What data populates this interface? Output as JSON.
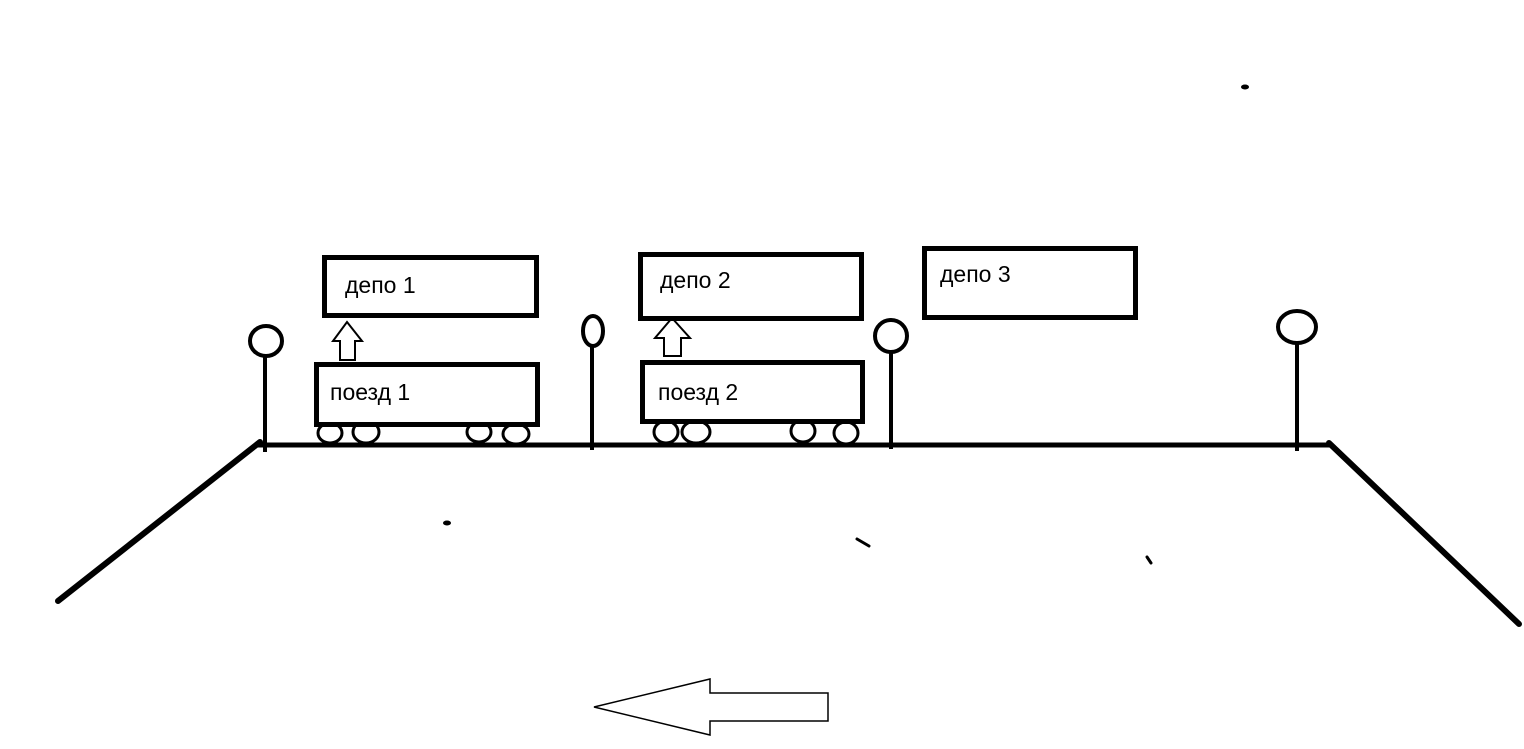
{
  "canvas": {
    "width_px": 1524,
    "height_px": 749,
    "background_color": "#ffffff",
    "ink_color": "#000000"
  },
  "depots": [
    {
      "label": "депо 1"
    },
    {
      "label": "депо 2"
    },
    {
      "label": "депо 3"
    }
  ],
  "trains": [
    {
      "label": "поезд 1",
      "wheel_count": 4
    },
    {
      "label": "поезд 2",
      "wheel_count": 4
    }
  ],
  "signals": {
    "count": 4,
    "shape": "circle-on-pole"
  },
  "up_arrows": {
    "count": 2,
    "direction": "up"
  },
  "direction_arrow": {
    "direction": "left"
  }
}
